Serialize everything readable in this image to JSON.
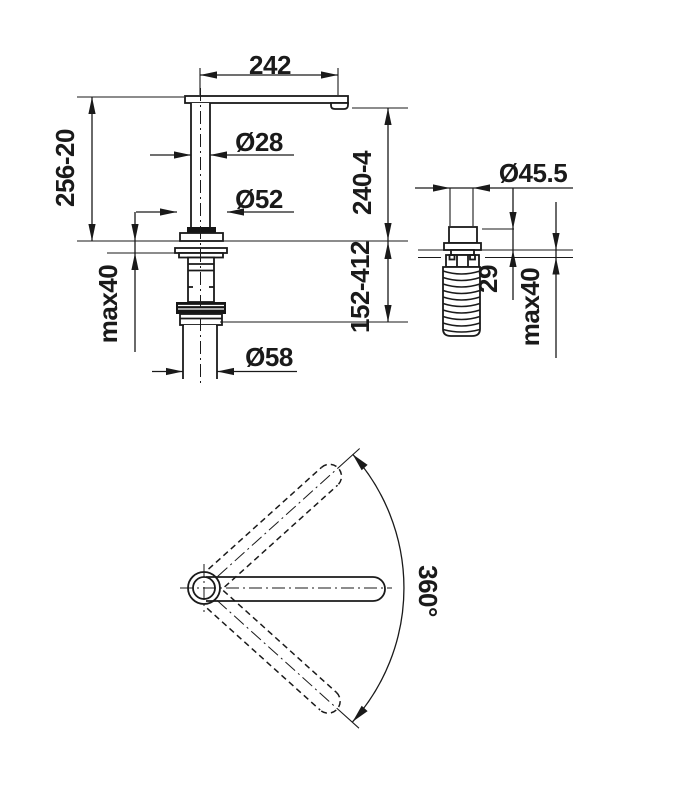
{
  "drawing": {
    "type": "faucet-dimension-drawing",
    "colors": {
      "line": "#1a1a1a",
      "background": "#ffffff"
    },
    "labels": {
      "spout_reach": "242",
      "spout_tube_diameter": "Ø28",
      "base_flange_diameter": "Ø52",
      "total_height": "256-20",
      "outlet_height": "240-4",
      "max_counter_left": "max40",
      "below_counter_depth": "152-412",
      "body_diameter": "Ø58",
      "hole_diameter": "Ø45.5",
      "shank_above_counter": "29",
      "max_counter_right": "max40",
      "swivel_angle": "360°"
    }
  }
}
